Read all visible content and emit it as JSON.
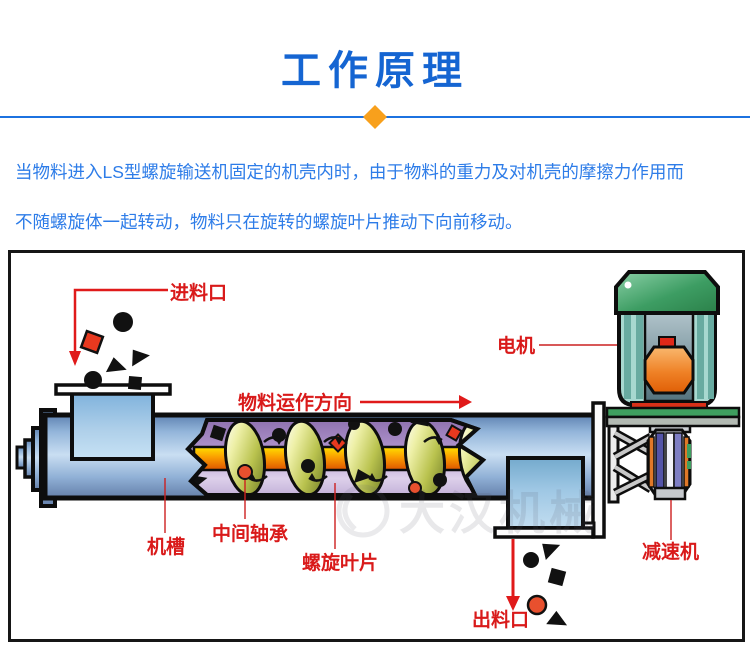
{
  "header": {
    "title": "工作原理",
    "accent_color": "#1565d2",
    "divider_color": "#1c72e0",
    "diamond_color": "#f8a01c"
  },
  "intro": {
    "line1": "当物料进入LS型螺旋输送机固定的机壳内时，由于物料的重力及对机壳的摩擦力作用而",
    "line2": "不随螺旋体一起转动，物料只在旋转的螺旋叶片推动下向前移动。",
    "text_color": "#2d7ce8"
  },
  "diagram": {
    "labels": {
      "inlet": "进料口",
      "direction": "物料运作方向",
      "motor": "电机",
      "trough": "机槽",
      "middle_bearing": "中间轴承",
      "spiral_blade": "螺旋叶片",
      "reducer": "减速机",
      "outlet": "出料口"
    },
    "label_color": "#d91a1a",
    "watermark": "大汉机械"
  }
}
